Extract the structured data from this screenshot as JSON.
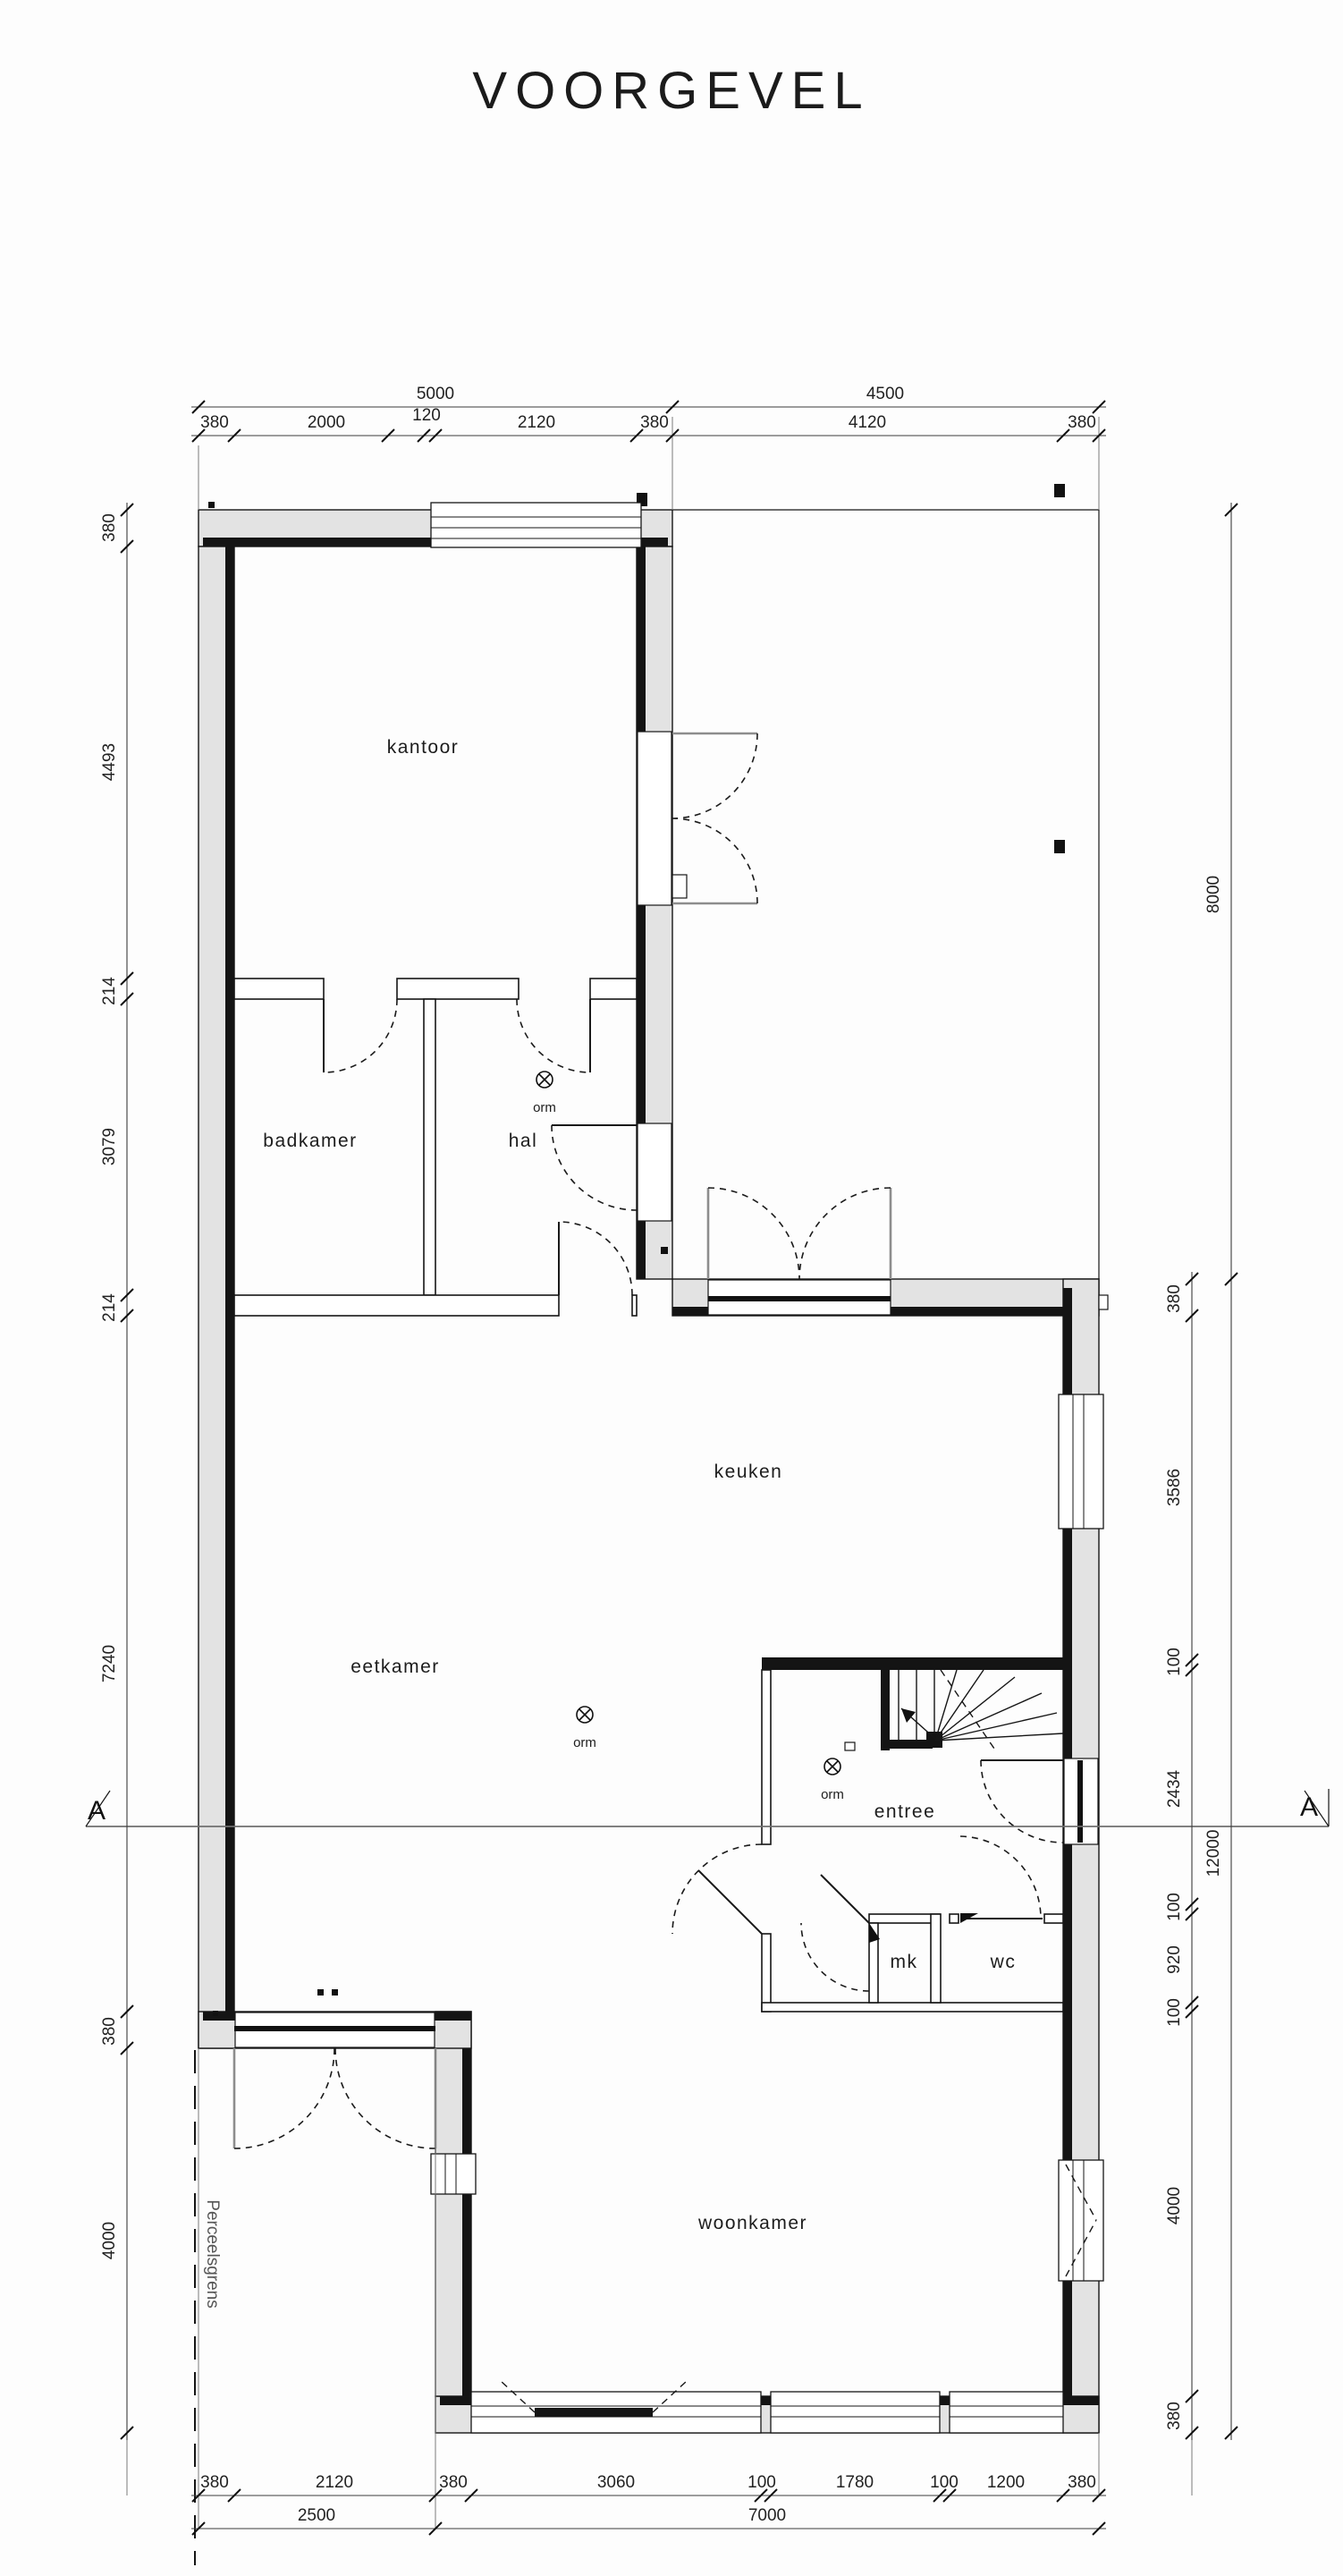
{
  "title": "VOORGEVEL",
  "rooms": {
    "kantoor": "kantoor",
    "badkamer": "badkamer",
    "hal": "hal",
    "keuken": "keuken",
    "eetkamer": "eetkamer",
    "entree": "entree",
    "mk": "mk",
    "wc": "wc",
    "woonkamer": "woonkamer"
  },
  "symbols": {
    "ceiling_light": "orm"
  },
  "boundary": {
    "label": "Perceelsgrens"
  },
  "section": {
    "label": "A"
  },
  "dims": {
    "top_overall": [
      "5000",
      "4500"
    ],
    "top_detail": [
      "380",
      "2000",
      "120",
      "2120",
      "380",
      "4120",
      "380"
    ],
    "left": [
      "380",
      "4493",
      "214",
      "3079",
      "214",
      "7240",
      "380",
      "4000"
    ],
    "right_outer": [
      "8000",
      "12000"
    ],
    "right_detail": [
      "380",
      "3586",
      "100",
      "2434",
      "100",
      "920",
      "100",
      "4000",
      "380"
    ],
    "bottom_detail": [
      "380",
      "2120",
      "380",
      "3060",
      "100",
      "1780",
      "100",
      "1200",
      "380"
    ],
    "bottom_overall": [
      "2500",
      "7000"
    ]
  }
}
